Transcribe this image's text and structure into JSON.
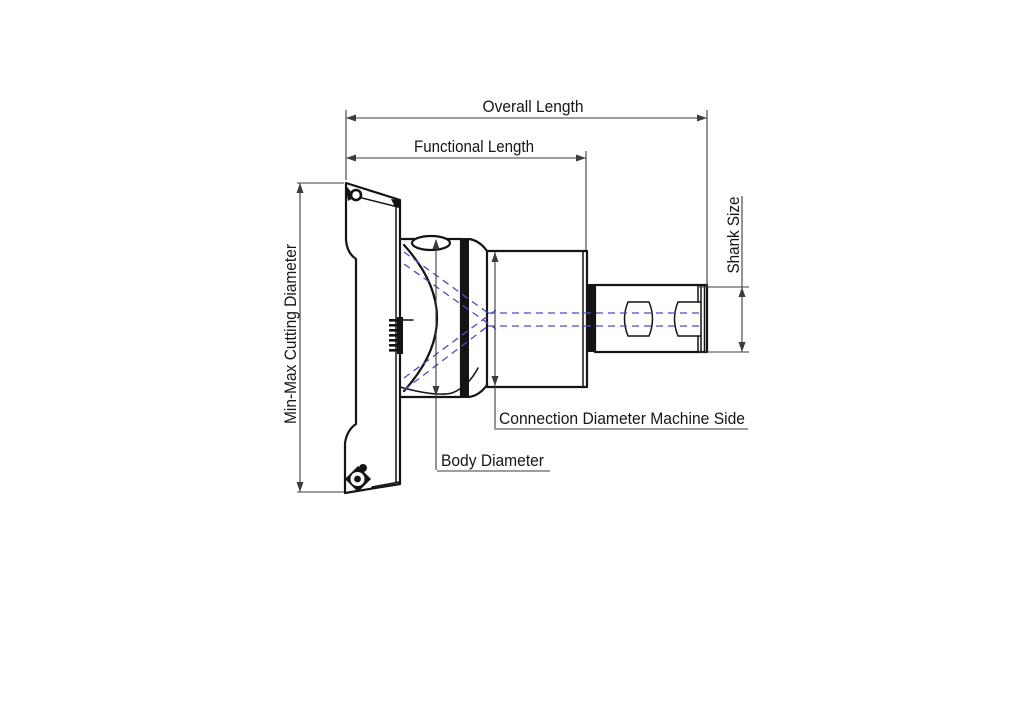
{
  "title": "Indexable cutting tool dimension diagram",
  "colors": {
    "background": "#ffffff",
    "line": "#141414",
    "dimension": "#3c3c3c",
    "coolant": "#4a4ec2",
    "text": "#161616"
  },
  "labels": {
    "overall_length": "Overall Length",
    "functional_length": "Functional Length",
    "min_max_cutting_diameter": "Min-Max Cutting Diameter",
    "shank_size": "Shank Size",
    "connection_diameter_machine_side": "Connection Diameter Machine Side",
    "body_diameter": "Body Diameter"
  }
}
